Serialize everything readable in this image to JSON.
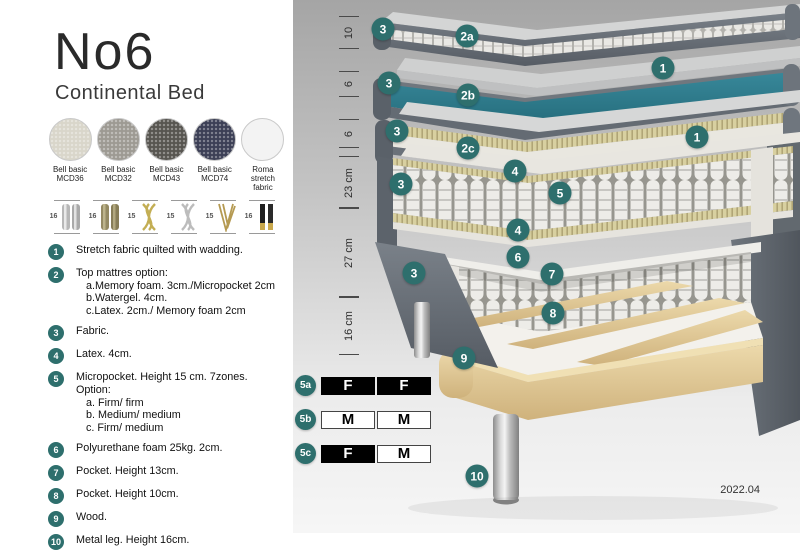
{
  "header": {
    "title": "No6",
    "subtitle": "Continental Bed"
  },
  "swatches": [
    {
      "name": "Bell basic\nMCD36",
      "color": "#d9d6ca"
    },
    {
      "name": "Bell basic\nMCD32",
      "color": "#9d9a93"
    },
    {
      "name": "Bell basic\nMCD43",
      "color": "#575550"
    },
    {
      "name": "Bell basic\nMCD74",
      "color": "#3c3f55"
    },
    {
      "name": "Roma\nstretch fabric",
      "color": "#f3f3f3"
    }
  ],
  "legs": [
    {
      "height": "16",
      "style": "chrome-cylinder"
    },
    {
      "height": "16",
      "style": "bronze-cylinder"
    },
    {
      "height": "15",
      "style": "gold-twist"
    },
    {
      "height": "15",
      "style": "silver-twist"
    },
    {
      "height": "15",
      "style": "gold-hairpin"
    },
    {
      "height": "16",
      "style": "black-gold-cone"
    }
  ],
  "legend": {
    "items": [
      {
        "num": "1",
        "text": "Stretch fabric quilted with wadding."
      },
      {
        "num": "2",
        "text": "Top mattres option:",
        "sub": [
          "a.Memory foam. 3cm./Micropocket 2cm",
          "b.Watergel. 4cm.",
          "c.Latex. 2cm./ Memory foam 2cm"
        ]
      },
      {
        "num": "3",
        "text": "Fabric."
      },
      {
        "num": "4",
        "text": "Latex. 4cm."
      },
      {
        "num": "5",
        "text": "Micropocket. Height 15 cm. 7zones. Option:",
        "sub": [
          "a. Firm/ firm",
          "b. Medium/ medium",
          "c. Firm/ medium"
        ]
      },
      {
        "num": "6",
        "text": "Polyurethane foam 25kg. 2cm."
      },
      {
        "num": "7",
        "text": "Pocket. Height 13cm."
      },
      {
        "num": "8",
        "text": "Pocket. Height 10cm."
      },
      {
        "num": "9",
        "text": "Wood."
      },
      {
        "num": "10",
        "text": "Metal leg. Height 16cm."
      }
    ]
  },
  "diagram": {
    "accent_color": "#2e6f6d",
    "watergel_color": "#2e7e8b",
    "ruler": [
      {
        "label": "10"
      },
      {
        "label": "6"
      },
      {
        "label": "6"
      },
      {
        "label": "23 cm"
      },
      {
        "label": "27 cm"
      },
      {
        "label": "16 cm"
      }
    ],
    "callouts": [
      {
        "label": "3"
      },
      {
        "label": "2a"
      },
      {
        "label": "1"
      },
      {
        "label": "3"
      },
      {
        "label": "2b"
      },
      {
        "label": "3"
      },
      {
        "label": "2c"
      },
      {
        "label": "1"
      },
      {
        "label": "3"
      },
      {
        "label": "4"
      },
      {
        "label": "5"
      },
      {
        "label": "4"
      },
      {
        "label": "6"
      },
      {
        "label": "3"
      },
      {
        "label": "7"
      },
      {
        "label": "8"
      },
      {
        "label": "9"
      },
      {
        "label": "10"
      }
    ]
  },
  "firmness": {
    "rows": [
      {
        "label": "5a",
        "cells": [
          {
            "text": "F",
            "variant": "dark"
          },
          {
            "text": "F",
            "variant": "dark"
          }
        ]
      },
      {
        "label": "5b",
        "cells": [
          {
            "text": "M",
            "variant": "light"
          },
          {
            "text": "M",
            "variant": "light"
          }
        ]
      },
      {
        "label": "5c",
        "cells": [
          {
            "text": "F",
            "variant": "dark"
          },
          {
            "text": "M",
            "variant": "light"
          }
        ]
      }
    ]
  },
  "footer": {
    "version": "2022.04"
  }
}
